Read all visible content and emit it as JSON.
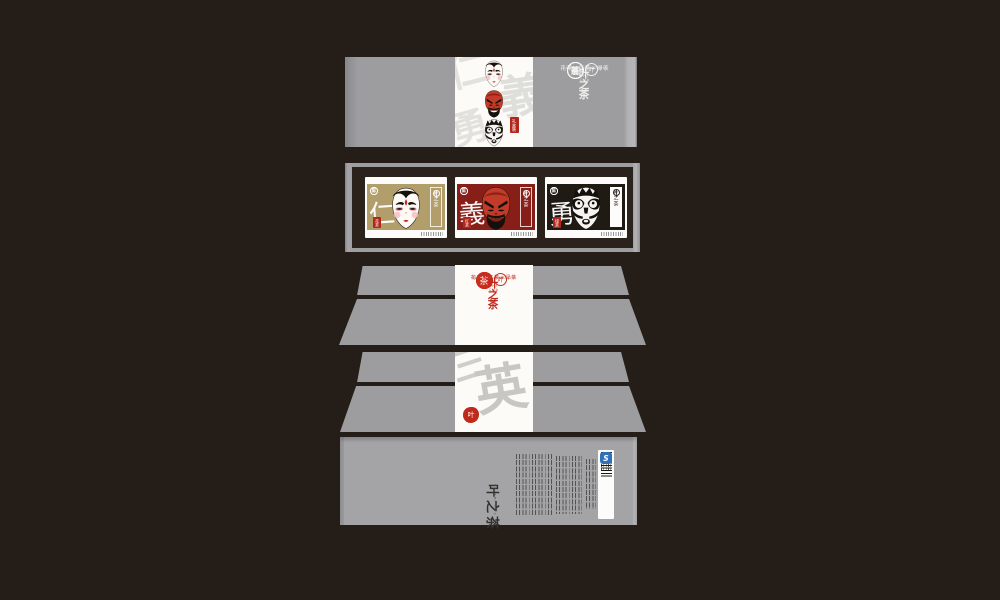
{
  "title": "San Shu Ming Cha tea packaging design presentation",
  "colors": {
    "background": "#251e18",
    "panel_gray": "#9d9da0",
    "paper_white": "#fcfbf8",
    "logo_red": "#c92c1e",
    "seal_red": "#b2271c",
    "card_gold": "#b29e6b",
    "card_dark_red": "#871e18",
    "card_black": "#201a15",
    "qs_blue": "#2e71b8"
  },
  "logo": {
    "seal_chars": [
      "三",
      "蜀",
      "茗",
      "茶"
    ],
    "english": "SAN SHU MING CHA",
    "teas": "花茶+红茶+绿茶",
    "brand_name": "叶之茶",
    "brand_sub": "YE ZHI CHA",
    "brand_icon_char": "叶"
  },
  "panel1": {
    "watermark_chars": [
      "仁",
      "義",
      "勇"
    ],
    "gift_seal": "礼盒装"
  },
  "cards": [
    {
      "virtue": "仁",
      "tea": "花茶",
      "seal_top": "三",
      "seal_bottom": "蜀",
      "mask": "white-face"
    },
    {
      "virtue": "義",
      "tea": "红茶",
      "seal_top": "三",
      "seal_bottom": "蜀",
      "mask": "red-face"
    },
    {
      "virtue": "勇",
      "tea": "绿茶",
      "seal_top": "三",
      "seal_bottom": "蜀",
      "mask": "black-face"
    }
  ],
  "panel4": {
    "wm1": "三",
    "wm2": "英",
    "seal_char": "叶"
  },
  "panel5": {
    "brand_vertical": "叶之茶",
    "brand_sub": "YE ZHI CHA",
    "qs_label": "S"
  }
}
